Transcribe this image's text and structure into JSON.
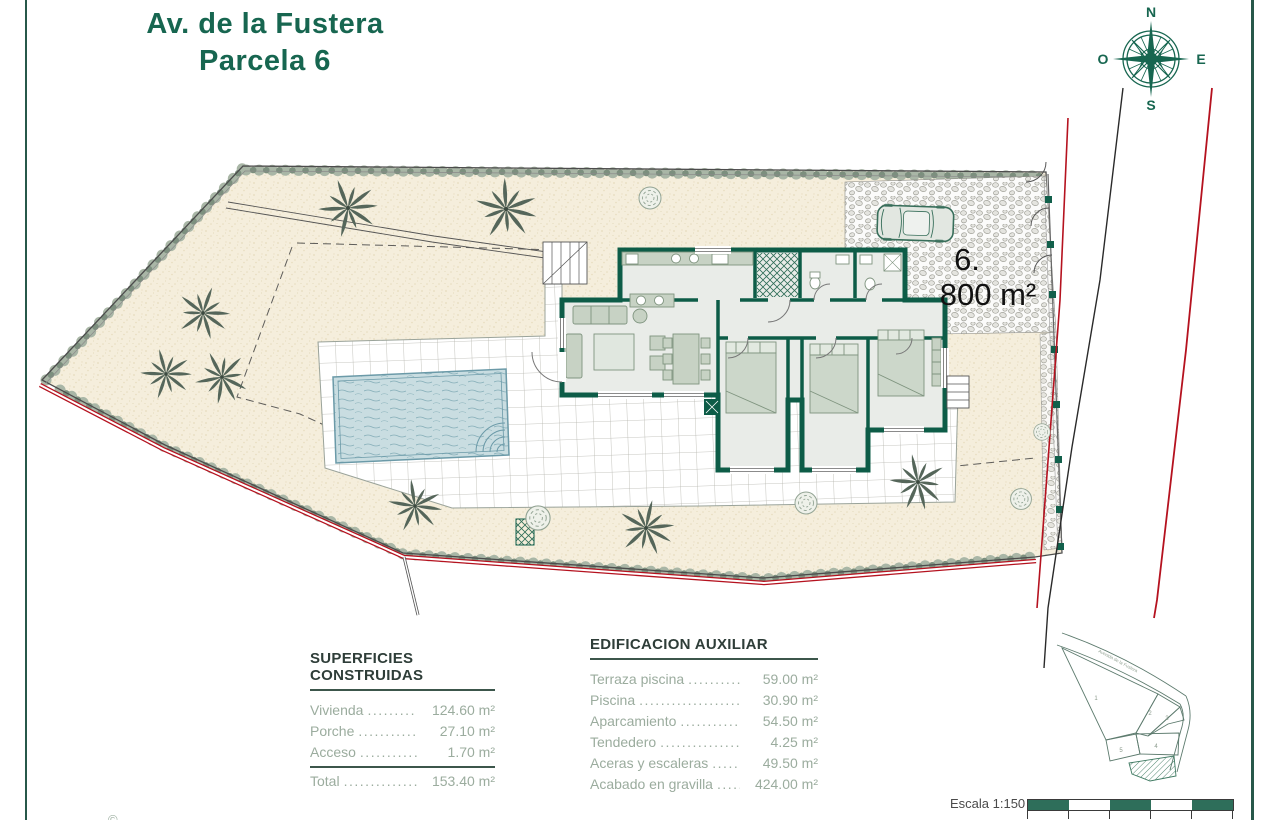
{
  "page": {
    "title_line1": "Av. de la Fustera",
    "title_line2": "Parcela 6",
    "footer_note": "©"
  },
  "compass": {
    "north": "N",
    "south": "S",
    "east": "E",
    "west": "O"
  },
  "site_plan": {
    "parcel_number": "6.",
    "parcel_area": "800 m²"
  },
  "tables": {
    "superficies": {
      "title": "SUPERFICIES CONSTRUIDAS",
      "rows": [
        {
          "label": "Vivienda",
          "value": "124.60 m²"
        },
        {
          "label": "Porche",
          "value": "27.10 m²"
        },
        {
          "label": "Acceso",
          "value": "1.70 m²"
        }
      ],
      "total": {
        "label": "Total",
        "value": "153.40 m²"
      }
    },
    "edificacion": {
      "title": "EDIFICACION AUXILIAR",
      "rows": [
        {
          "label": "Terraza piscina",
          "value": "59.00 m²"
        },
        {
          "label": "Piscina",
          "value": "30.90 m²"
        },
        {
          "label": "Aparcamiento",
          "value": "54.50 m²"
        },
        {
          "label": "Tendedero",
          "value": "4.25 m²"
        },
        {
          "label": "Aceras y escaleras",
          "value": "49.50 m²"
        },
        {
          "label": "Acabado en gravilla",
          "value": "424.00 m²"
        }
      ]
    }
  },
  "minimap": {
    "street_label": "Avenida de la Fustera",
    "parcels": [
      "1",
      "2",
      "3",
      "4",
      "5"
    ],
    "scale_label": "Escala 1:150"
  },
  "colors": {
    "accent_green": "#176650",
    "wall_green": "#0d5c47",
    "road_red": "#b5121f",
    "sand": "#f5eedc"
  }
}
